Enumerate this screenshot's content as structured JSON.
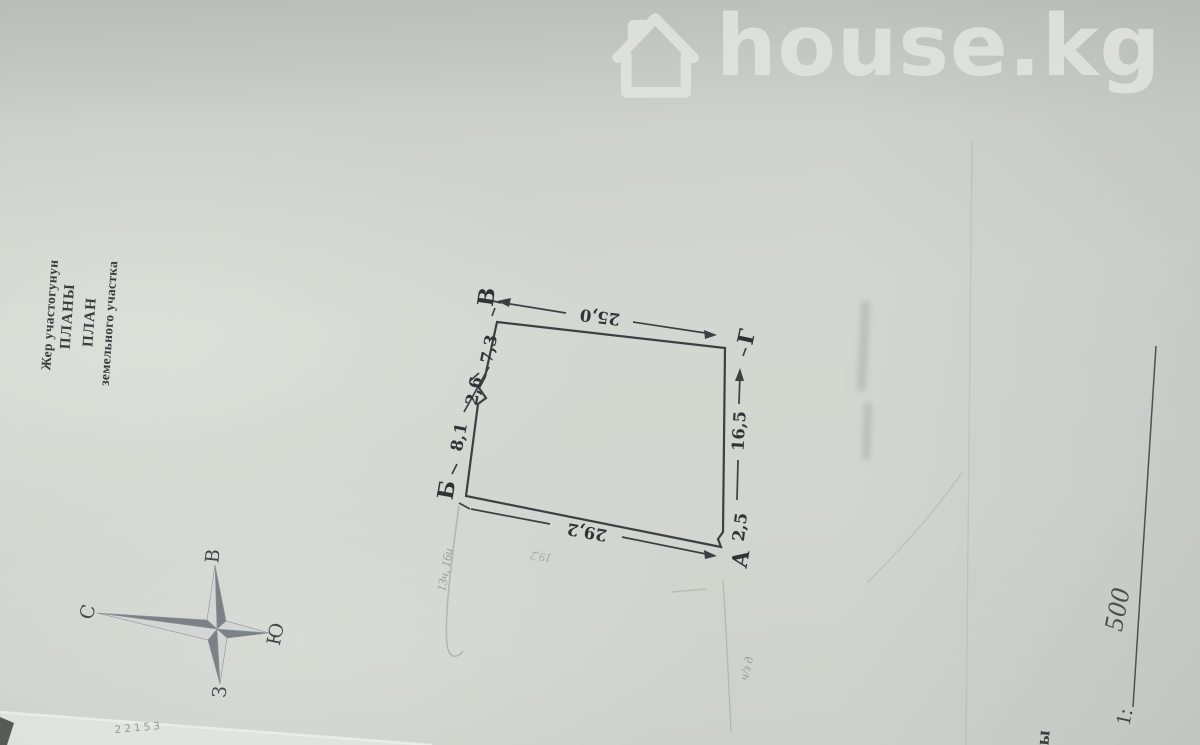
{
  "watermark": {
    "brand": "house.kg"
  },
  "title_block": {
    "kyrgyz": {
      "line1": "Жер участогунун",
      "line2": "ПЛАНЫ"
    },
    "russian": {
      "line1": "ПЛАН",
      "line2": "земельного участка"
    }
  },
  "compass": {
    "north_label": "С",
    "south_label": "Ю",
    "east_label": "В",
    "west_label": "З"
  },
  "plan": {
    "vertex_a": "А",
    "vertex_b": "Б",
    "vertex_v": "В",
    "vertex_g": "Г",
    "dim_top": "25,0",
    "dim_bottom": "29,2",
    "dim_right_main": "16,5",
    "dim_right_near_a": "2,5",
    "dim_left_seg1": "8,1",
    "dim_left_seg2": "2,6",
    "dim_left_seg3": "7,3"
  },
  "scale": {
    "label": "1:",
    "value": "500"
  },
  "pencil_notes": {
    "near_b": "13ч, 16и",
    "below_bottom_edge": "19,2",
    "below_a": "ч/з д"
  },
  "fragments": {
    "bottom_left": "22153",
    "bottom_right": "ы"
  },
  "colors": {
    "paper": "#ced1cb",
    "ink": "#3a3e40",
    "watermark": "#e3e6e1",
    "pencil": "#9aa09c",
    "band_light": "#e1e3de",
    "corner_dark": "#555b55"
  }
}
